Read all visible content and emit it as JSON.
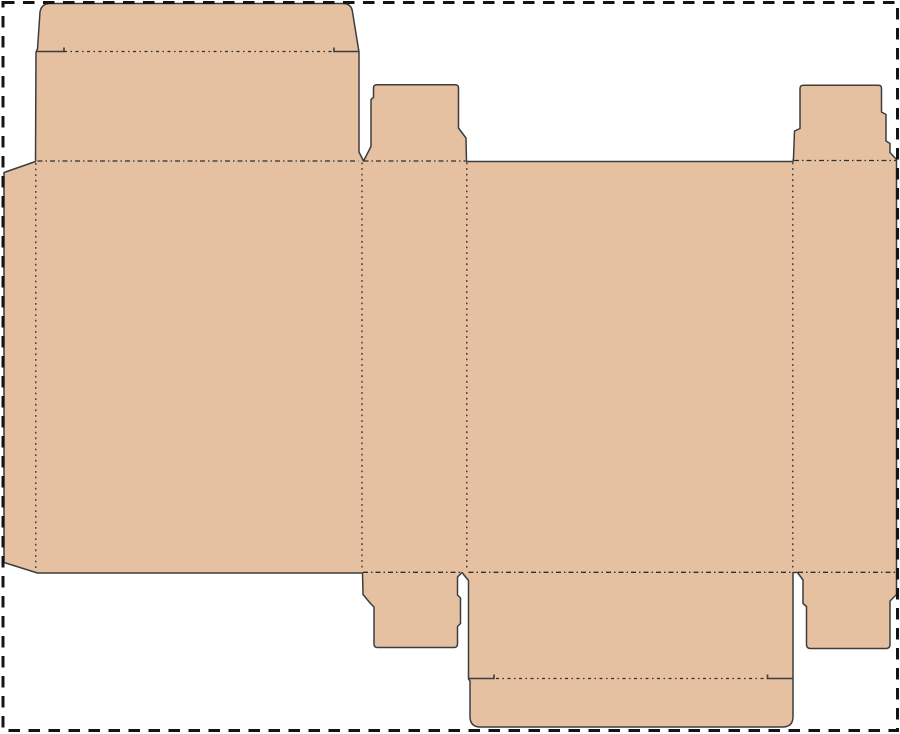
{
  "page": {
    "background": "#ffffff",
    "width": 900,
    "height": 734,
    "description": "packaging-dieline-tuck-box-template"
  },
  "border": {
    "x": 3,
    "y": 2.5,
    "width": 894.5,
    "height": 728,
    "color": "#141414",
    "stroke_width": 3,
    "dash": "11.5 8.5"
  },
  "dieline": {
    "board_fill": "#e5c1a2",
    "cut_color": "#3d3d3d",
    "fold_color": "#2e2e2e",
    "outline_path": "M40,12 Q41.5,3.5 50,3.5 L343,3.5 Q351.5,3.5 352.5,12 L359,52 L359,152 L363.5,161 L371,146.5 L371,99.5 L373.5,97.5 L373.5,88 Q373.5,84.7 377,84.7 L455,84.7 Q458.5,84.7 458.5,88 L458.5,128 L466,138 L466.5,161.5 L793,161.5 L793.5,158 L794.5,131 L800,128.5 L800,88.5 Q800,85.3 803.5,85.3 L878.5,85.3 Q881.5,85.3 881.5,88.5 L881.5,112 L886,114.5 L886,141 L890,143.5 L890,152.5 L896.5,159.5 L896.5,594.5 L890,601 L890,644.5 Q890,648.5 886,648.5 L810.5,648.5 Q806.5,648.5 806.5,644.5 L806.5,606.5 L803,603.5 L803,580 L797.5,572.5 L793,572.5 L793,716.5 Q793,727 782.5,727 L480.5,727 Q470,727 470,716.5 L470,681 L468.5,679 L468.5,580.5 L462,572.5 L457.5,577 L457.5,595 L460.5,598 L460.5,623.5 L457.5,626.5 L457.5,644 Q457.5,647.5 454,647.5 L377.5,647.5 Q374,647.5 374,644 L374,607 L370.5,603.5 L363,594.5 L362.5,573 L37.5,573 L4,562.5 L4,172.5 L35.5,161.5 L36,52 L37.5,49 Z",
    "fold_lines": [
      {
        "name": "fold-top-tuck",
        "path": "M64,51.5 L334,51.5",
        "dash": "3 3.5 1.5 3.5"
      },
      {
        "name": "fold-top-lid",
        "path": "M37.5,161 L358.5,161",
        "dash": "5 3 1.5 3"
      },
      {
        "name": "fold-top-dust-left",
        "path": "M363.5,161 L465.5,161",
        "dash": "5 3 1.5 3"
      },
      {
        "name": "fold-top-dust-right",
        "path": "M794,160.5 L896,160.5",
        "dash": "5 3 1.5 3"
      },
      {
        "name": "fold-bottom-dust-left",
        "path": "M363,572.3 L461,572.3",
        "dash": "5 3 1.5 3"
      },
      {
        "name": "fold-bottom-lid",
        "path": "M468.5,572.3 L792.5,572.3",
        "dash": "5 3 1.5 3"
      },
      {
        "name": "fold-bottom-dust-right",
        "path": "M798,572.3 L896,572.3",
        "dash": "5 3 1.5 3"
      },
      {
        "name": "fold-glue-flap",
        "path": "M35.8,163 L35.8,570.5",
        "dash": "1.8 3.8"
      },
      {
        "name": "fold-panel-left",
        "path": "M362,162.5 L362,571",
        "dash": "1.8 3.8"
      },
      {
        "name": "fold-panel-mid",
        "path": "M466.8,162.5 L466.8,571",
        "dash": "1.8 3.8"
      },
      {
        "name": "fold-panel-right",
        "path": "M792.8,162.5 L792.8,570",
        "dash": "1.8 3.8"
      },
      {
        "name": "fold-bottom-tuck",
        "path": "M496,678.5 L766,678.5",
        "dash": "3 3.5 1.5 3.5"
      }
    ],
    "slit_lines": [
      {
        "name": "slit-top-left",
        "path": "M36.5,51.5 L64,51.5 L64,47.5"
      },
      {
        "name": "slit-top-right",
        "path": "M334,47.5 L334,51.5 L359,51.5"
      },
      {
        "name": "slit-bottom-left",
        "path": "M468.5,678.5 L494,678.5 L494,674.5"
      },
      {
        "name": "slit-bottom-right",
        "path": "M767.5,674.5 L767.5,678.5 L792.5,678.5"
      }
    ]
  }
}
